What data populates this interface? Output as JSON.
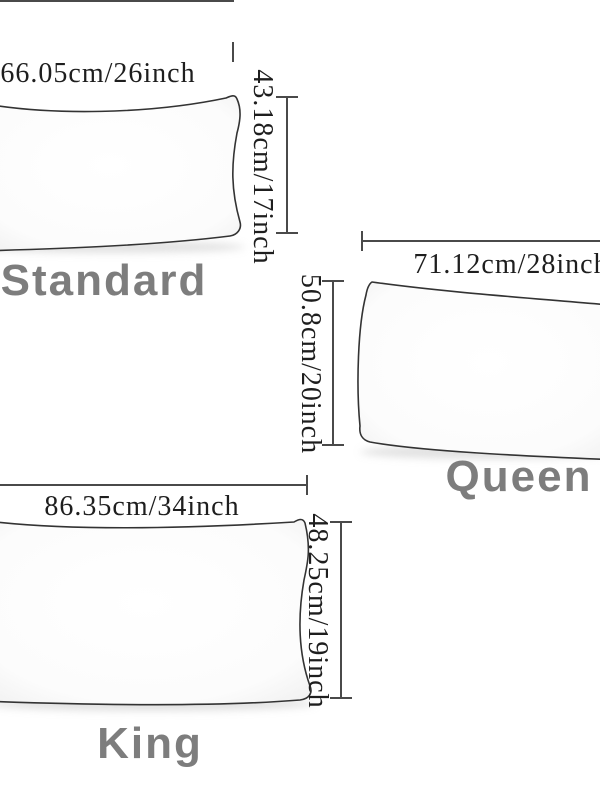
{
  "colors": {
    "background": "#ffffff",
    "label_gray": "#7d7d7d",
    "dimension_line": "#4a4a4a",
    "dimension_text": "#1e1e1e",
    "pillow_fill": "#fdfdfd",
    "pillow_outline": "#333333"
  },
  "pillows": [
    {
      "name": "Standard",
      "width_label": "66.05cm/26inch",
      "height_label": "43.18cm/17inch"
    },
    {
      "name": "Queen",
      "width_label": "71.12cm/28inch",
      "height_label": "50.8cm/20inch"
    },
    {
      "name": "King",
      "width_label": "86.35cm/34inch",
      "height_label": "48.25cm/19inch"
    }
  ]
}
